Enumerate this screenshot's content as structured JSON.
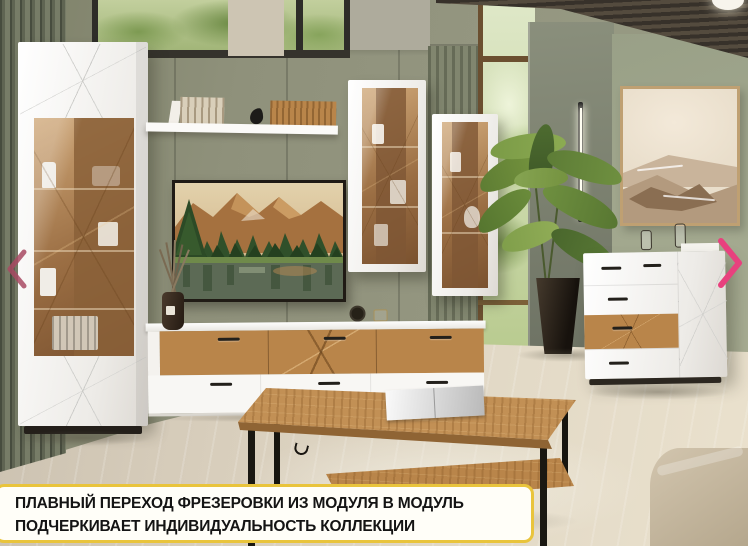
{
  "slide": {
    "caption": {
      "line1": "ПЛАВНЫЙ ПЕРЕХОД ФРЕЗЕРОВКИ ИЗ МОДУЛЯ В МОДУЛЬ",
      "line2": "ПОДЧЕРКИВАЕТ ИНДИВИДУАЛЬНОСТЬ КОЛЛЕКЦИИ"
    },
    "nav": {
      "prev_icon": "chevron-left",
      "next_icon": "chevron-right"
    },
    "colors": {
      "caption_border": "#e9c43c",
      "caption_bg": "#fffef8",
      "caption_text": "#141414",
      "prev_arrow": "#a84a63",
      "next_arrow": "#e8417e",
      "wall_sage": "#8f917b",
      "oak_wood": "#b9854a",
      "furniture_white": "#f7f6f3",
      "floor_wood": "#d8cebc"
    }
  }
}
